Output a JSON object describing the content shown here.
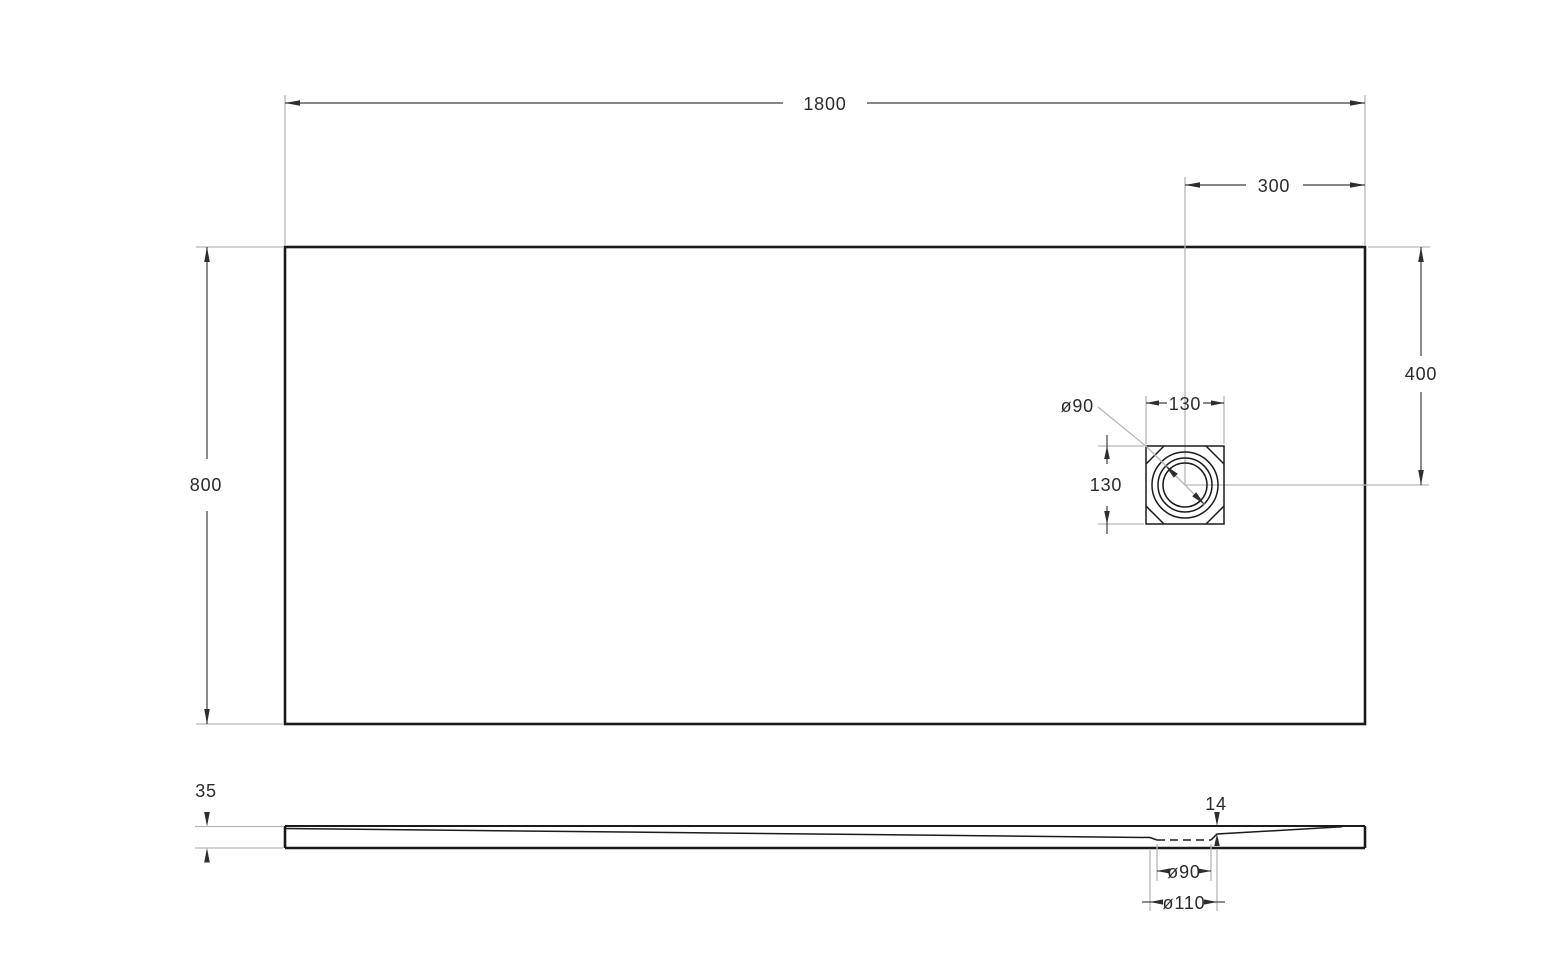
{
  "drawing": {
    "description": "Shower tray technical drawing, top view and side section view",
    "top_view": {
      "overall_width": "1800",
      "overall_depth": "800",
      "drain_offset_from_right": "300",
      "drain_offset_from_top": "400",
      "drain_square_width": "130",
      "drain_square_height": "130",
      "drain_diameter": "ø90"
    },
    "side_view": {
      "thickness": "35",
      "drain_recess_depth": "14",
      "drain_hole_diameter": "ø90",
      "drain_flange_diameter": "ø110"
    },
    "colors": {
      "background": "#ffffff",
      "outline": "#1b1b1b",
      "dimension_line": "#3d3d3d",
      "extension_line": "#b7b7b7",
      "text": "#2b2b2b"
    }
  }
}
